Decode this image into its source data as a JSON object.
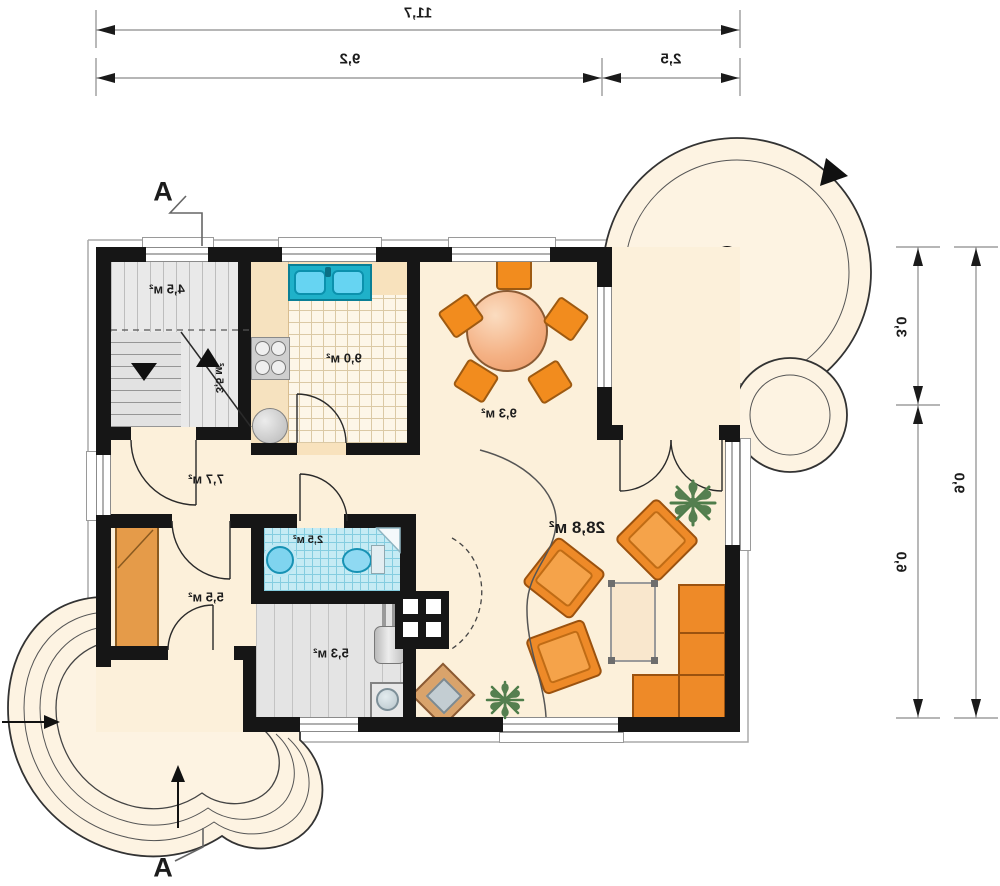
{
  "plan": {
    "section_marker": "A",
    "dimensions": {
      "top_total": "11,7",
      "top_main": "9,2",
      "top_terrace": "2,5",
      "right_upper": "3,0",
      "right_lower": "6,0",
      "right_total": "9,0"
    },
    "rooms": {
      "staircase_hall": "4,5 м²",
      "stairs": "3,5 м²",
      "kitchen": "9,0 м²",
      "dining": "9,3 м²",
      "hall": "7,7 м²",
      "bathroom": "2,5 м²",
      "wardrobe_room": "5,5 м²",
      "utility": "5,3 м²",
      "living": "28,8 м²"
    },
    "icons": {
      "plant_glyph": "✻"
    },
    "colors": {
      "wall": "#161616",
      "floor_cream": "#fcf0da",
      "floor_peach": "#f8e2bd",
      "furniture_orange": "#ee8a28",
      "sink_teal": "#1fb1c9",
      "bath_tile": "#c5ebf4",
      "terrace_fill": "#fdf3e2"
    }
  }
}
